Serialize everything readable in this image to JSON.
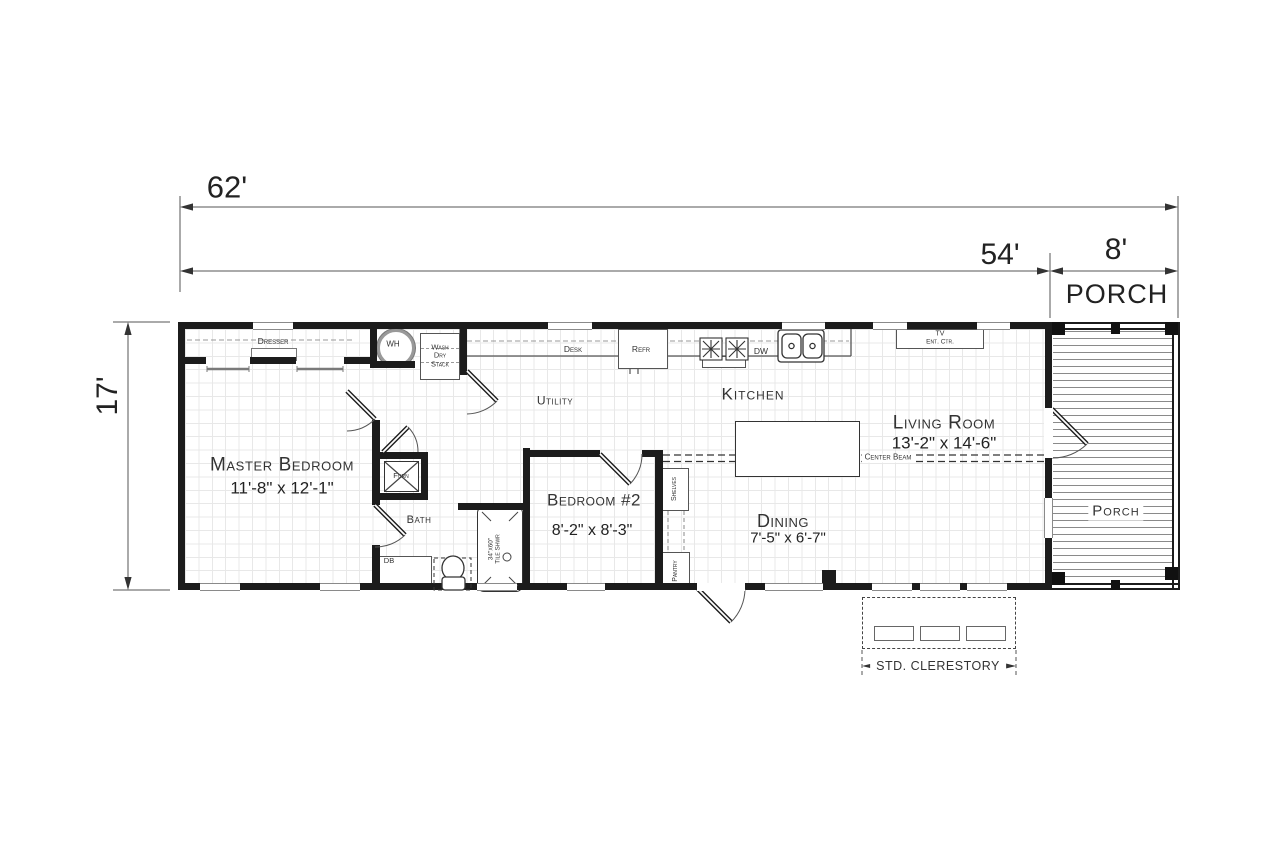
{
  "dimensions": {
    "total": "62'",
    "main": "54'",
    "porch_w": "8'",
    "porch_title": "PORCH",
    "depth": "17'"
  },
  "rooms": {
    "master": {
      "name": "Master Bedroom",
      "size": "11'-8\" x 12'-1\""
    },
    "bedroom2": {
      "name": "Bedroom #2",
      "size": "8'-2\" x 8'-3\""
    },
    "living": {
      "name": "Living Room",
      "size": "13'-2\" x 14'-6\""
    },
    "dining": {
      "name": "Dining",
      "size": "7'-5\" x 6'-7\""
    },
    "kitchen": "Kitchen",
    "utility": "Utility",
    "bath": "Bath",
    "porch": "Porch"
  },
  "labels": {
    "dresser": "Dresser",
    "wh": "WH",
    "wash": "Wash",
    "dry": "Dry",
    "stack": "Stack",
    "desk": "Desk",
    "refr": "Refr",
    "dw": "DW",
    "tv": "TV",
    "ent_ctr": "Ent. Ctr.",
    "furn": "Furn",
    "db": "DB",
    "shelves": "Shelves",
    "pantry": "Pantry",
    "shwr_size": "34\"x60\"",
    "shwr_name": "Tile Shwr",
    "center_beam": "Center Beam",
    "clerestory": "STD. CLERESTORY"
  }
}
